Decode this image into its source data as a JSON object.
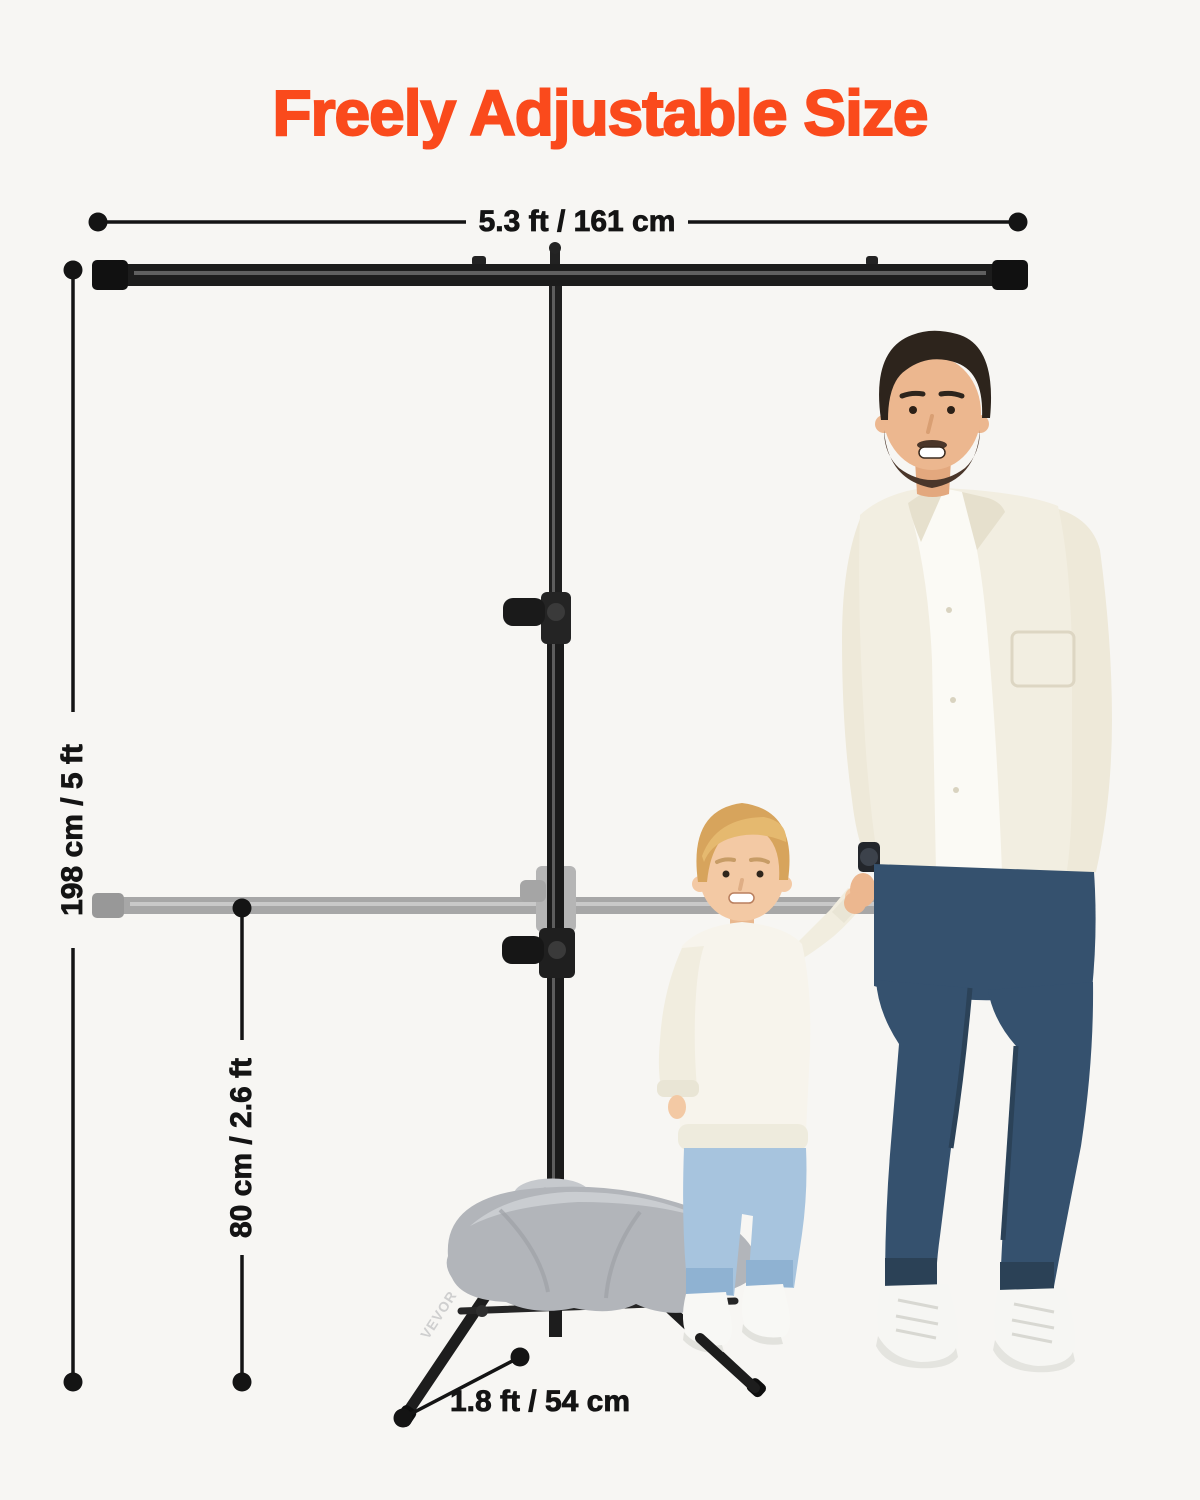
{
  "page": {
    "title": "Freely Adjustable Size"
  },
  "theme": {
    "accent": "#fa4a1c",
    "background": "#f7f6f3",
    "dimension_color": "#141414",
    "stand_color": "#1c1c1c",
    "ghost_bar_color": "#a9a9a9",
    "sandbag_color": "#b2b5ba"
  },
  "dimensions": {
    "crossbar_width": {
      "label": "5.3 ft / 161 cm"
    },
    "max_height": {
      "label": "198 cm / 5 ft"
    },
    "min_height": {
      "label": "80 cm / 2.6 ft"
    },
    "leg_length": {
      "label": "1.8 ft / 54 cm"
    }
  },
  "stand": {
    "brand": "VEVOR"
  }
}
